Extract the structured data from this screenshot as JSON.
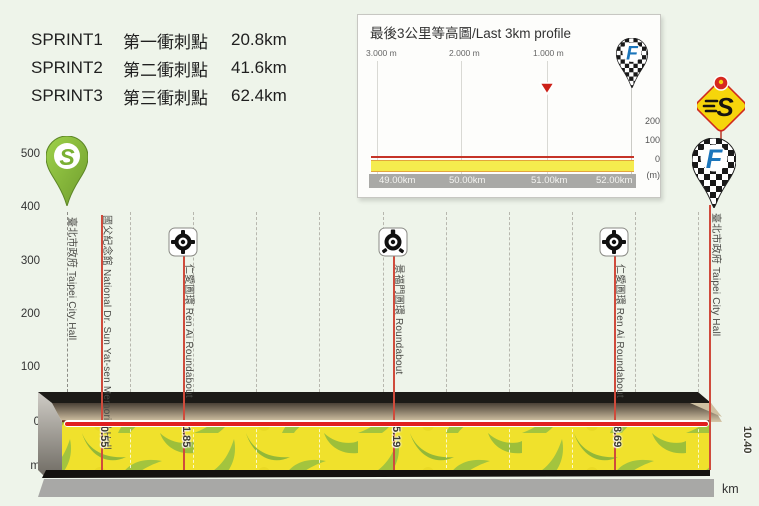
{
  "sprint_panel": {
    "rows": [
      {
        "id": "SPRINT1",
        "zh": "第一衝刺點",
        "distance": "20.8km"
      },
      {
        "id": "SPRINT2",
        "zh": "第二衝刺點",
        "distance": "41.6km"
      },
      {
        "id": "SPRINT3",
        "zh": "第三衝刺點",
        "distance": "62.4km"
      }
    ]
  },
  "inset": {
    "title": "最後3公里等高圖/Last 3km profile",
    "togo_markers": [
      "3.000 m",
      "2.000 m",
      "1.000 m"
    ],
    "x_ticks": [
      "49.00km",
      "50.00km",
      "51.00km",
      "52.00km"
    ],
    "y_ticks": [
      "200",
      "100",
      "0",
      "(m)"
    ]
  },
  "main_chart": {
    "y_ticks": [
      "500",
      "400",
      "300",
      "200",
      "100",
      "0"
    ],
    "y_unit": "m",
    "x_ticks": [
      "0",
      "1",
      "2",
      "3",
      "4",
      "5",
      "6",
      "7",
      "8",
      "9",
      "10"
    ],
    "x_unit": "km",
    "waypoints": [
      {
        "name": "臺北市政府 Taipei City Hall",
        "km": ""
      },
      {
        "name": "國父紀念館 National Dr. Sun Yat-sen Memorial Hall",
        "km": "0.55"
      },
      {
        "name": "仁愛圓環 Ren Ai Roundabout",
        "km": "1.85"
      },
      {
        "name": "景福門圓環 Roundabout",
        "km": "5.19"
      },
      {
        "name": "仁愛圓環 Ren Ai Roundabout",
        "km": "8.69"
      },
      {
        "name": "臺北市政府 Taipei City Hall",
        "km": "10.40"
      }
    ]
  },
  "icons": {
    "start_pin_letter": "S",
    "sprint_diamond_letter": "S",
    "finish_pin_letter": "F",
    "inset_finish_pin_letter": "F"
  },
  "colors": {
    "background": "#eef4ea",
    "event_line_red": "#cf4b3c",
    "zero_line_red": "#e01f1f",
    "band_yellow": "#f0e12c",
    "band_green": "#a3c43e",
    "axis_bar_gray": "#a9a9a6",
    "start_pin_green": "#8bc53f",
    "sprint_diamond_yellow": "#f6d50b",
    "finish_f_blue": "#1b75bb"
  },
  "chart_data": [
    {
      "type": "area",
      "title": "Stage profile (flat urban circuit)",
      "xlabel": "km",
      "ylabel": "m",
      "xlim": [
        0,
        10.4
      ],
      "ylim": [
        0,
        500
      ],
      "x_ticks": [
        0,
        1,
        2,
        3,
        4,
        5,
        6,
        7,
        8,
        9,
        10
      ],
      "y_ticks": [
        0,
        100,
        200,
        300,
        400,
        500
      ],
      "grid": "vertical-dashed-per-km",
      "series": [
        {
          "name": "elevation",
          "x": [
            0,
            10.4
          ],
          "y": [
            5,
            5
          ]
        }
      ],
      "waypoints": [
        {
          "km": 0.0,
          "name": "臺北市政府 Taipei City Hall",
          "marker": "start-pin"
        },
        {
          "km": 0.55,
          "name": "國父紀念館 National Dr. Sun Yat-sen Memorial Hall",
          "marker": "line"
        },
        {
          "km": 1.85,
          "name": "仁愛圓環 Ren Ai Roundabout",
          "marker": "roundabout"
        },
        {
          "km": 5.19,
          "name": "景福門圓環 Roundabout",
          "marker": "roundabout"
        },
        {
          "km": 8.69,
          "name": "仁愛圓環 Ren Ai Roundabout",
          "marker": "roundabout"
        },
        {
          "km": 10.4,
          "name": "臺北市政府 Taipei City Hall",
          "marker": "finish-pin"
        }
      ],
      "sprints": [
        {
          "id": "SPRINT1",
          "name_zh": "第一衝刺點",
          "km": 20.8
        },
        {
          "id": "SPRINT2",
          "name_zh": "第二衝刺點",
          "km": 41.6
        },
        {
          "id": "SPRINT3",
          "name_zh": "第三衝刺點",
          "km": 62.4
        }
      ]
    },
    {
      "type": "area",
      "title": "最後3公里等高圖/Last 3km profile",
      "x_tick_labels": [
        "49.00km",
        "50.00km",
        "51.00km",
        "52.00km"
      ],
      "y_ticks": [
        0,
        100,
        200
      ],
      "y_unit": "(m)",
      "distance_to_go_markers": [
        "3.000 m",
        "2.000 m",
        "1.000 m"
      ],
      "flamme_rouge_marker_at": "1.000 m",
      "finish_at": "52.2km",
      "series": [
        {
          "name": "elevation",
          "x": [
            49.0,
            52.2
          ],
          "y": [
            3,
            3
          ]
        }
      ]
    }
  ]
}
